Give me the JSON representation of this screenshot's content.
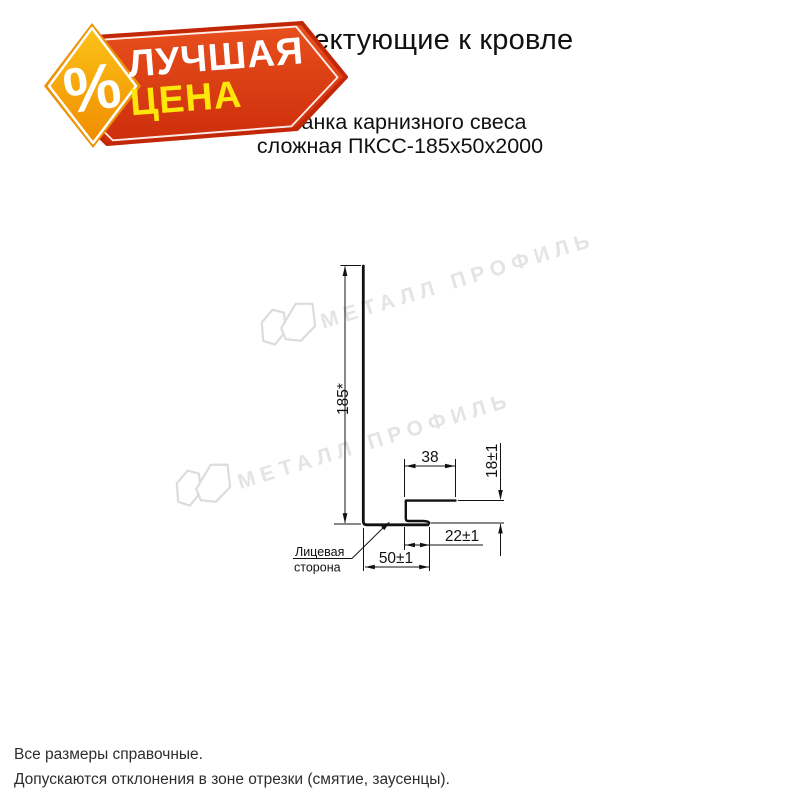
{
  "badge": {
    "percent": "%",
    "line1": "ЛУЧШАЯ",
    "line2": "ЦЕНА",
    "colors": {
      "red_top": "#e8501d",
      "red_bottom": "#cd2d0b",
      "red_outline": "#c22708",
      "diamond_top": "#fcc318",
      "diamond_bottom": "#f08c00",
      "diamond_rim": "#ee9205",
      "text_white": "#ffffff",
      "text_yellow": "#ffe60a"
    }
  },
  "header": {
    "title": "Комплектующие к кровле",
    "subtitle_line1": "Планка карнизного свеса",
    "subtitle_line2": "сложная ПКСС-185х50х2000"
  },
  "drawing": {
    "dim_height": "185*",
    "dim_hook_width": "38",
    "dim_hook_height": "18±1",
    "dim_hook_return": "22±1",
    "dim_base": "50±1",
    "face_label_1": "Лицевая",
    "face_label_2": "сторона"
  },
  "watermark": {
    "text": "МЕТАЛЛ ПРОФИЛЬ"
  },
  "footer": {
    "line1": "Все размеры справочные.",
    "line2": "Допускаются отклонения в зоне отрезки (смятие, заусенцы)."
  }
}
